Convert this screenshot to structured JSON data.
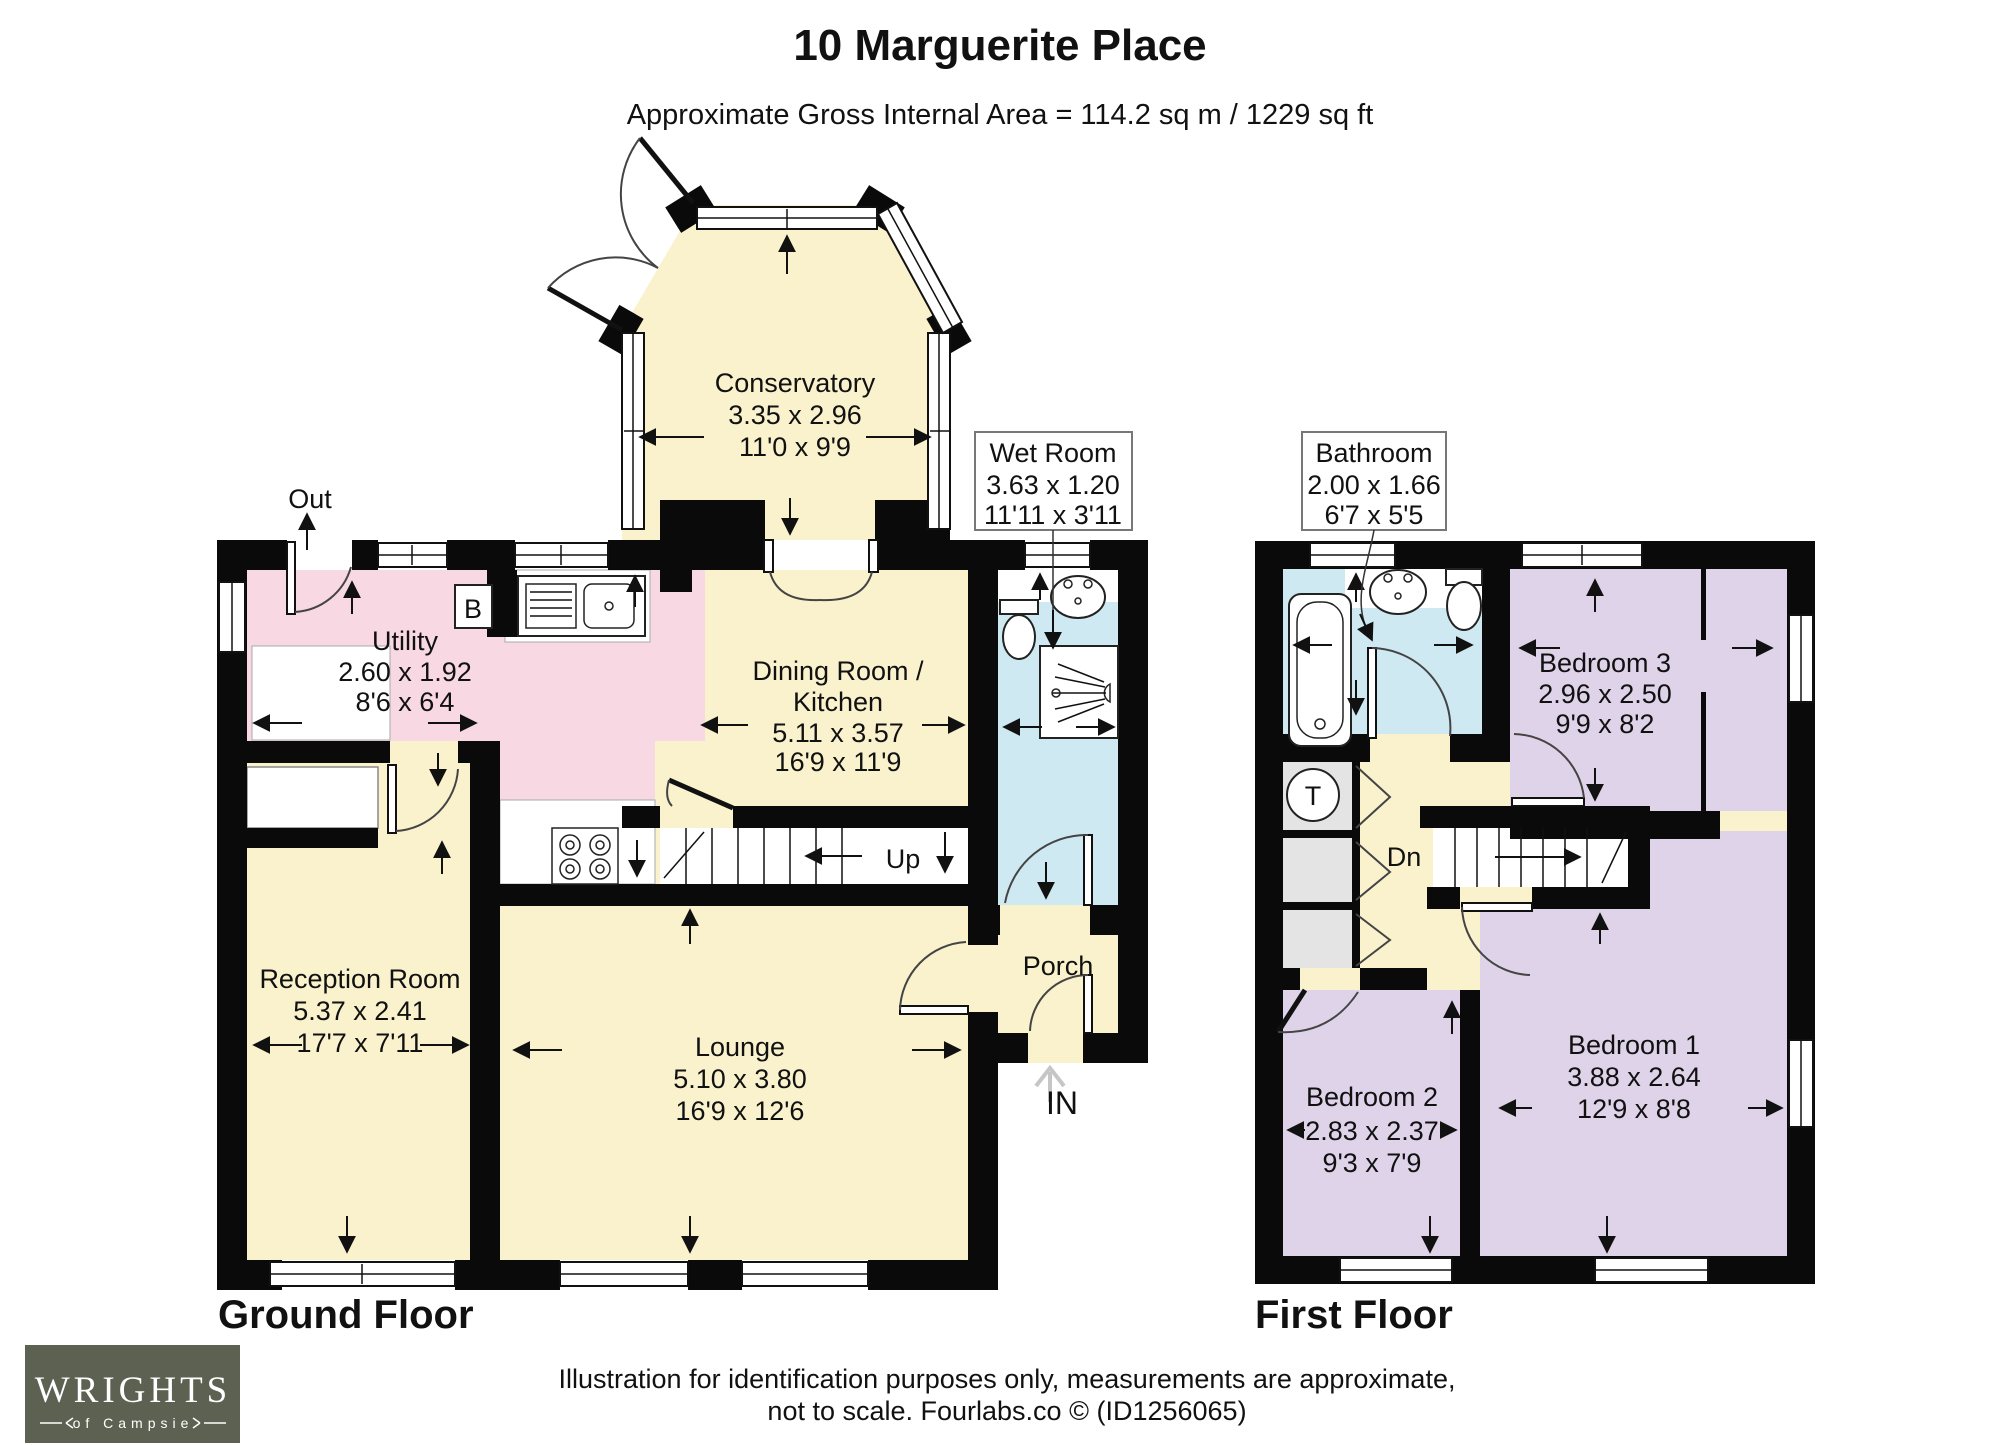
{
  "title": "10 Marguerite Place",
  "subtitle": "Approximate Gross Internal Area = 114.2 sq m / 1229 sq ft",
  "ground": {
    "label": "Ground Floor",
    "conservatory": {
      "name": "Conservatory",
      "m": "3.35 x 2.96",
      "ft": "11'0 x 9'9"
    },
    "utility": {
      "name": "Utility",
      "m": "2.60 x 1.92",
      "ft": "8'6 x 6'4"
    },
    "dining": {
      "name1": "Dining Room /",
      "name2": "Kitchen",
      "m": "5.11 x 3.57",
      "ft": "16'9 x 11'9"
    },
    "reception": {
      "name": "Reception Room",
      "m": "5.37 x 2.41",
      "ft": "17'7 x 7'11"
    },
    "lounge": {
      "name": "Lounge",
      "m": "5.10 x 3.80",
      "ft": "16'9 x 12'6"
    },
    "wet_room": {
      "name": "Wet Room",
      "m": "3.63 x 1.20",
      "ft": "11'11 x 3'11"
    },
    "porch": {
      "name": "Porch"
    },
    "out": "Out",
    "entry": "IN",
    "up": "Up",
    "boiler": "B"
  },
  "first": {
    "label": "First Floor",
    "bathroom": {
      "name": "Bathroom",
      "m": "2.00 x 1.66",
      "ft": "6'7 x 5'5"
    },
    "bedroom3": {
      "name": "Bedroom 3",
      "m": "2.96 x 2.50",
      "ft": "9'9 x 8'2"
    },
    "bedroom2": {
      "name": "Bedroom 2",
      "m": "2.83 x 2.37",
      "ft": "9'3 x 7'9"
    },
    "bedroom1": {
      "name": "Bedroom 1",
      "m": "3.88 x 2.64",
      "ft": "12'9 x 8'8"
    },
    "down": "Dn",
    "tank": "T"
  },
  "footer": {
    "line1": "Illustration for identification purposes only, measurements are approximate,",
    "line2": "not to scale. Fourlabs.co © (ID1256065)"
  },
  "logo": {
    "name": "WRIGHTS",
    "tagline": "of Campsie"
  },
  "colors": {
    "room_cream": "#f9f2cd",
    "room_pink": "#f7d8e3",
    "room_blue": "#cfe9f2",
    "room_purple": "#ded3e8",
    "closet_gray": "#e4e4e4",
    "wall_black": "#0a0a0a",
    "logo_background": "#5c6152"
  }
}
